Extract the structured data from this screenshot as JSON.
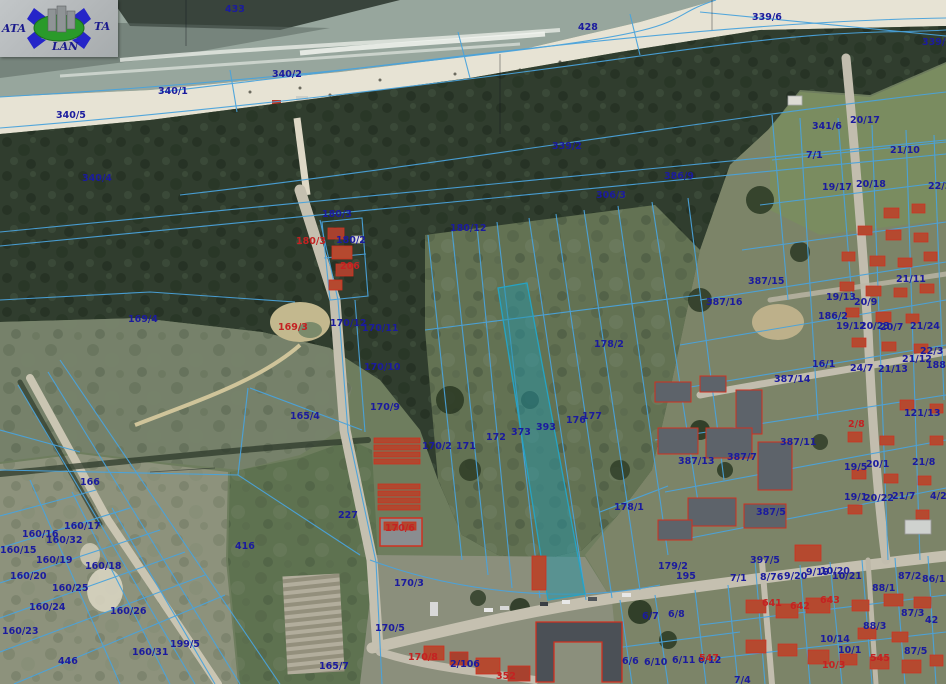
{
  "map": {
    "description": "Cadastral parcel overlay on aerial orthophoto of coastal town (beach, dune forest, fields, built-up area)",
    "highlighted_parcel": "393",
    "colors": {
      "parcel_line_blue": "#4aa3dc",
      "label_blue": "#1b1b9e",
      "label_red": "#c42222",
      "highlight_fill": "#2396aa",
      "sea": "#97a69d",
      "sand": "#e7e3d4",
      "forest": "#303d2e",
      "meadow": "#76816a",
      "field": "#5e7250",
      "urban_ground": "#7c8468",
      "road": "#c5c0b0",
      "building_roof": "#b5492f",
      "building_block": "#4b5056"
    },
    "logo": {
      "left_text": "ATA",
      "right_text": "TA",
      "bottom_text": "LAN"
    },
    "labels": [
      {
        "t": "433",
        "x": 225,
        "y": 4
      },
      {
        "t": "428",
        "x": 578,
        "y": 22
      },
      {
        "t": "339/6",
        "x": 752,
        "y": 12
      },
      {
        "t": "339/3",
        "x": 922,
        "y": 37
      },
      {
        "t": "340/2",
        "x": 272,
        "y": 69
      },
      {
        "t": "340/1",
        "x": 158,
        "y": 86
      },
      {
        "t": "340/5",
        "x": 56,
        "y": 110
      },
      {
        "t": "340/4",
        "x": 82,
        "y": 173
      },
      {
        "t": "339/2",
        "x": 552,
        "y": 141
      },
      {
        "t": "341/6",
        "x": 812,
        "y": 121
      },
      {
        "t": "20/17",
        "x": 850,
        "y": 115
      },
      {
        "t": "21/10",
        "x": 890,
        "y": 145
      },
      {
        "t": "7/1",
        "x": 806,
        "y": 150
      },
      {
        "t": "19/17",
        "x": 822,
        "y": 182
      },
      {
        "t": "20/18",
        "x": 856,
        "y": 179
      },
      {
        "t": "22/2",
        "x": 928,
        "y": 181
      },
      {
        "t": "386/9",
        "x": 664,
        "y": 171
      },
      {
        "t": "306/3",
        "x": 596,
        "y": 190
      },
      {
        "t": "180/12",
        "x": 450,
        "y": 223
      },
      {
        "t": "180/3",
        "x": 322,
        "y": 209
      },
      {
        "t": "180/3",
        "x": 296,
        "y": 236,
        "c": "r"
      },
      {
        "t": "180/2",
        "x": 336,
        "y": 235
      },
      {
        "t": "206",
        "x": 340,
        "y": 261,
        "c": "r"
      },
      {
        "t": "169/4",
        "x": 128,
        "y": 314
      },
      {
        "t": "169/3",
        "x": 278,
        "y": 322,
        "c": "r"
      },
      {
        "t": "170/12",
        "x": 330,
        "y": 318
      },
      {
        "t": "170/11",
        "x": 362,
        "y": 323
      },
      {
        "t": "170/10",
        "x": 364,
        "y": 362
      },
      {
        "t": "170/9",
        "x": 370,
        "y": 402
      },
      {
        "t": "165/4",
        "x": 290,
        "y": 411
      },
      {
        "t": "170/2",
        "x": 422,
        "y": 441
      },
      {
        "t": "171",
        "x": 456,
        "y": 441
      },
      {
        "t": "172",
        "x": 486,
        "y": 432
      },
      {
        "t": "373",
        "x": 511,
        "y": 427
      },
      {
        "t": "393",
        "x": 536,
        "y": 422
      },
      {
        "t": "176",
        "x": 566,
        "y": 415
      },
      {
        "t": "177",
        "x": 582,
        "y": 411
      },
      {
        "t": "178/2",
        "x": 594,
        "y": 339
      },
      {
        "t": "178/1",
        "x": 614,
        "y": 502
      },
      {
        "t": "387/15",
        "x": 748,
        "y": 276
      },
      {
        "t": "387/16",
        "x": 706,
        "y": 297
      },
      {
        "t": "186/2",
        "x": 818,
        "y": 311
      },
      {
        "t": "19/13",
        "x": 826,
        "y": 292
      },
      {
        "t": "20/9",
        "x": 854,
        "y": 297
      },
      {
        "t": "21/11",
        "x": 896,
        "y": 274
      },
      {
        "t": "19/12",
        "x": 836,
        "y": 321
      },
      {
        "t": "20/23",
        "x": 860,
        "y": 321
      },
      {
        "t": "20/7",
        "x": 880,
        "y": 322
      },
      {
        "t": "21/24",
        "x": 910,
        "y": 321
      },
      {
        "t": "22/3",
        "x": 920,
        "y": 346
      },
      {
        "t": "21/12",
        "x": 902,
        "y": 354
      },
      {
        "t": "188",
        "x": 926,
        "y": 360
      },
      {
        "t": "16/1",
        "x": 812,
        "y": 359
      },
      {
        "t": "24/7",
        "x": 850,
        "y": 363
      },
      {
        "t": "21/13",
        "x": 878,
        "y": 364
      },
      {
        "t": "387/14",
        "x": 774,
        "y": 374
      },
      {
        "t": "387/13",
        "x": 678,
        "y": 456
      },
      {
        "t": "387/7",
        "x": 727,
        "y": 452
      },
      {
        "t": "387/11",
        "x": 780,
        "y": 437
      },
      {
        "t": "2/8",
        "x": 848,
        "y": 419,
        "c": "r"
      },
      {
        "t": "121/13",
        "x": 904,
        "y": 408
      },
      {
        "t": "19/5",
        "x": 844,
        "y": 462
      },
      {
        "t": "20/1",
        "x": 866,
        "y": 459
      },
      {
        "t": "21/8",
        "x": 912,
        "y": 457
      },
      {
        "t": "19/1",
        "x": 844,
        "y": 492
      },
      {
        "t": "20/22",
        "x": 864,
        "y": 493
      },
      {
        "t": "21/7",
        "x": 892,
        "y": 491
      },
      {
        "t": "4/2",
        "x": 930,
        "y": 491
      },
      {
        "t": "387/5",
        "x": 756,
        "y": 507
      },
      {
        "t": "166",
        "x": 80,
        "y": 477
      },
      {
        "t": "160/17",
        "x": 64,
        "y": 521
      },
      {
        "t": "160/16",
        "x": 22,
        "y": 529
      },
      {
        "t": "160/32",
        "x": 46,
        "y": 535
      },
      {
        "t": "160/15",
        "x": 0,
        "y": 545
      },
      {
        "t": "160/19",
        "x": 36,
        "y": 555
      },
      {
        "t": "160/18",
        "x": 85,
        "y": 561
      },
      {
        "t": "160/20",
        "x": 10,
        "y": 571
      },
      {
        "t": "160/25",
        "x": 52,
        "y": 583
      },
      {
        "t": "160/24",
        "x": 29,
        "y": 602
      },
      {
        "t": "160/26",
        "x": 110,
        "y": 606
      },
      {
        "t": "160/23",
        "x": 2,
        "y": 626
      },
      {
        "t": "199/5",
        "x": 170,
        "y": 639
      },
      {
        "t": "160/31",
        "x": 132,
        "y": 647
      },
      {
        "t": "446",
        "x": 58,
        "y": 656
      },
      {
        "t": "416",
        "x": 235,
        "y": 541
      },
      {
        "t": "227",
        "x": 338,
        "y": 510
      },
      {
        "t": "170/6",
        "x": 385,
        "y": 523,
        "c": "r"
      },
      {
        "t": "170/3",
        "x": 394,
        "y": 578
      },
      {
        "t": "170/5",
        "x": 375,
        "y": 623
      },
      {
        "t": "165/7",
        "x": 319,
        "y": 661
      },
      {
        "t": "170/8",
        "x": 408,
        "y": 652,
        "c": "r"
      },
      {
        "t": "2/106",
        "x": 450,
        "y": 659
      },
      {
        "t": "352",
        "x": 496,
        "y": 671,
        "c": "r"
      },
      {
        "t": "179/2",
        "x": 658,
        "y": 561
      },
      {
        "t": "195",
        "x": 676,
        "y": 571
      },
      {
        "t": "6/7",
        "x": 642,
        "y": 611
      },
      {
        "t": "6/8",
        "x": 668,
        "y": 609
      },
      {
        "t": "6/6",
        "x": 622,
        "y": 656
      },
      {
        "t": "6/10",
        "x": 644,
        "y": 657
      },
      {
        "t": "6/11",
        "x": 672,
        "y": 655
      },
      {
        "t": "6/12",
        "x": 698,
        "y": 655
      },
      {
        "t": "397/5",
        "x": 750,
        "y": 555
      },
      {
        "t": "7/1",
        "x": 730,
        "y": 573
      },
      {
        "t": "8/76",
        "x": 760,
        "y": 572
      },
      {
        "t": "9/20",
        "x": 784,
        "y": 571
      },
      {
        "t": "9/19",
        "x": 806,
        "y": 567
      },
      {
        "t": "10/20",
        "x": 820,
        "y": 566
      },
      {
        "t": "10/21",
        "x": 832,
        "y": 571
      },
      {
        "t": "641",
        "x": 762,
        "y": 598,
        "c": "r"
      },
      {
        "t": "642",
        "x": 790,
        "y": 601,
        "c": "r"
      },
      {
        "t": "643",
        "x": 820,
        "y": 595,
        "c": "r"
      },
      {
        "t": "87/2",
        "x": 898,
        "y": 571
      },
      {
        "t": "86/1",
        "x": 922,
        "y": 574
      },
      {
        "t": "88/1",
        "x": 872,
        "y": 583
      },
      {
        "t": "87/3",
        "x": 901,
        "y": 608
      },
      {
        "t": "42",
        "x": 925,
        "y": 615
      },
      {
        "t": "88/3",
        "x": 863,
        "y": 621
      },
      {
        "t": "10/14",
        "x": 820,
        "y": 634
      },
      {
        "t": "10/1",
        "x": 838,
        "y": 645
      },
      {
        "t": "87/5",
        "x": 904,
        "y": 646
      },
      {
        "t": "545",
        "x": 870,
        "y": 653,
        "c": "r"
      },
      {
        "t": "10/3",
        "x": 822,
        "y": 660,
        "c": "r"
      },
      {
        "t": "7/4",
        "x": 734,
        "y": 675
      },
      {
        "t": "547",
        "x": 699,
        "y": 653,
        "c": "r"
      }
    ]
  }
}
